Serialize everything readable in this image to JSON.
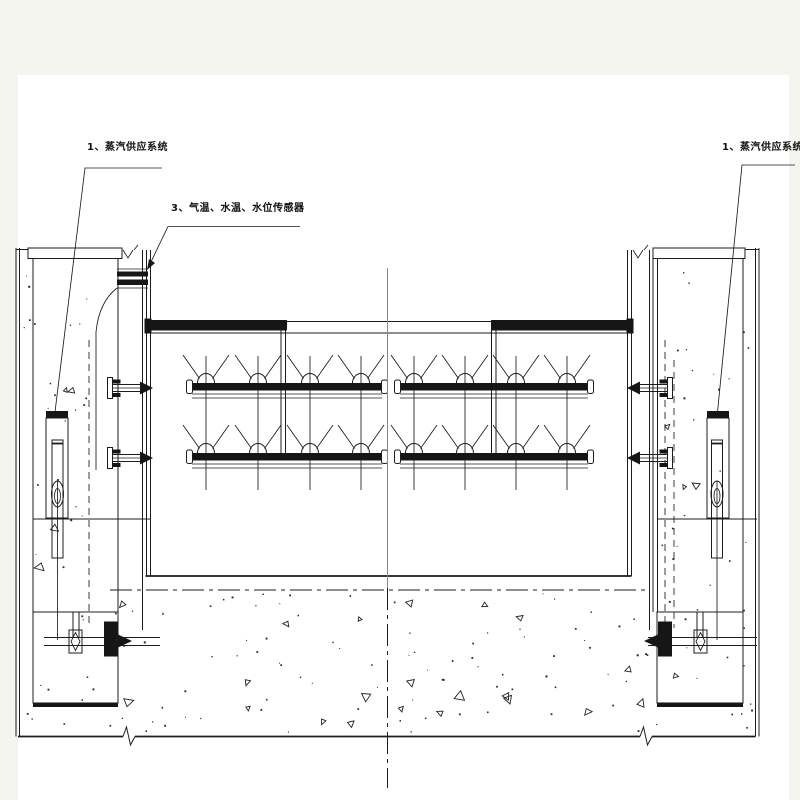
{
  "colors": {
    "background": "#f4f5ef",
    "sheet": "#ffffff",
    "line": "#1c1c1c",
    "centerline_gray": "#8a8a8a"
  },
  "labels": {
    "steam_supply_left": "1、蒸汽供应系统",
    "sensors": "3、气温、水温、水位传感器",
    "steam_supply_right": "1、蒸汽供应系统"
  }
}
